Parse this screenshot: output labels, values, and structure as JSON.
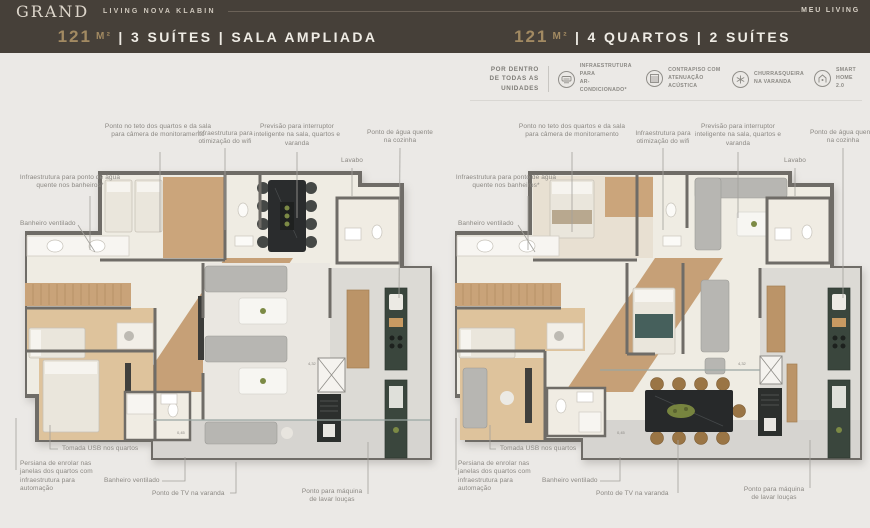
{
  "header": {
    "brand": "GRAND",
    "brand_tagline": "LIVING NOVA KLABIN",
    "right_label": "MEU LIVING"
  },
  "plans": [
    {
      "area_value": "121",
      "area_unit": "M²",
      "title_suffix": "| 3 SUÍTES | SALA AMPLIADA"
    },
    {
      "area_value": "121",
      "area_unit": "M²",
      "title_suffix": "| 4 QUARTOS | 2 SUÍTES"
    }
  ],
  "features": {
    "intro_line1": "POR DENTRO",
    "intro_line2": "DE TODAS AS UNIDADES",
    "items": [
      {
        "icon": "ac-unit-icon",
        "label_line1": "INFRAESTRUTURA PARA",
        "label_line2": "AR-CONDICIONADO*"
      },
      {
        "icon": "acoustic-floor-icon",
        "label_line1": "CONTRAPISO COM",
        "label_line2": "ATENUAÇÃO ACÚSTICA"
      },
      {
        "icon": "grill-icon",
        "label_line1": "CHURRASQUEIRA",
        "label_line2": "NA VARANDA"
      },
      {
        "icon": "smart-home-icon",
        "label_line1": "SMART",
        "label_line2": "HOME 2.0"
      }
    ]
  },
  "annotations": {
    "camera": "Ponto no teto dos quartos e da sala para câmera de monitoramento",
    "wifi": "Infraestrutura para otimização do wifi",
    "switch": "Previsão para interruptor inteligente na sala, quartos e varanda",
    "hot_water_kitchen": "Ponto de água quente na cozinha",
    "lavabo": "Lavabo",
    "hot_water_bath": "Infraestrutura para ponto de água quente nos banheiros*",
    "vent_bath": "Banheiro ventilado",
    "usb": "Tomada USB nos quartos",
    "blinds": "Persiana de enrolar nas janelas dos quartos com infraestrutura para automação",
    "tv_balcony": "Ponto de TV na varanda",
    "dishwasher": "Ponto para máquina de lavar louças",
    "dim_a": "4,32",
    "dim_b": "0,45"
  },
  "colors": {
    "header_bg": "#464039",
    "accent_gold": "#a28a62",
    "plan_wall": "#6f6c67",
    "kitchen_green": "#3a463d",
    "wood_floor": "#c6a077"
  }
}
